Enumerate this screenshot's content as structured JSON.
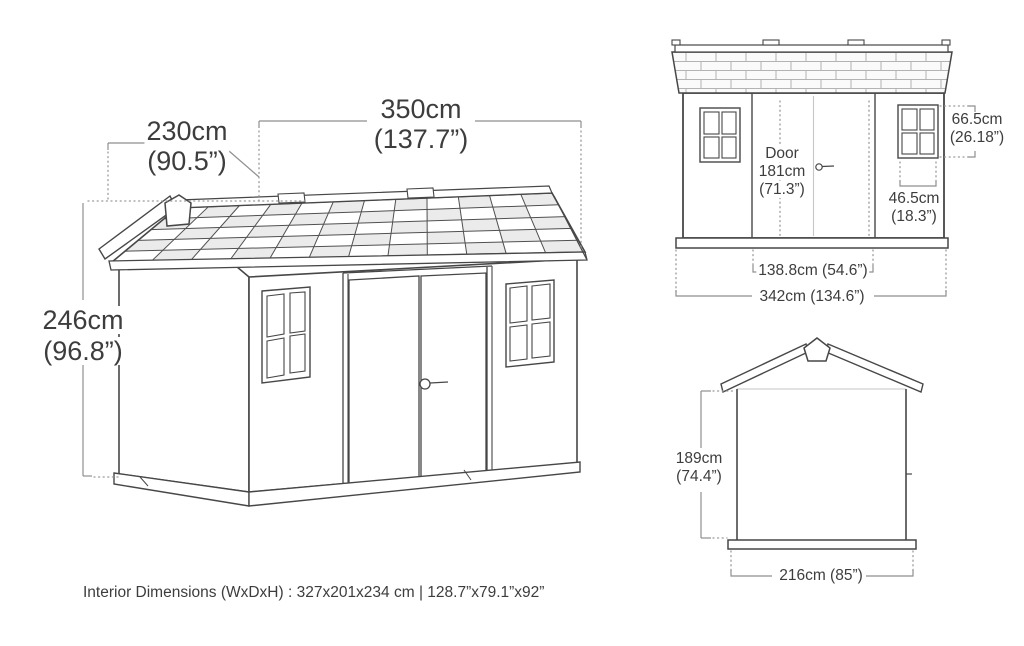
{
  "colors": {
    "background": "#ffffff",
    "line": "#474747",
    "dim_line": "#8f8f8f",
    "text": "#3d3d3d",
    "shingle_shade": "#ebebeb",
    "shingle_grid": "#505050"
  },
  "perspective_view": {
    "depth_label": {
      "cm": "230cm",
      "inches": "(90.5”)"
    },
    "width_label": {
      "cm": "350cm",
      "inches": "(137.7”)"
    },
    "height_label": {
      "cm": "246cm",
      "inches": "(96.8”)"
    }
  },
  "front_view": {
    "door_label": {
      "line1": "Door",
      "line2": "181cm",
      "line3": "(71.3”)"
    },
    "window_height_label": {
      "cm": "66.5cm",
      "inches": "(26.18”)"
    },
    "window_width_label": {
      "cm": "46.5cm",
      "inches": "(18.3”)"
    },
    "door_span_label": "138.8cm (54.6”)",
    "overall_width_label": "342cm (134.6”)"
  },
  "side_view": {
    "wall_height_label": {
      "cm": "189cm",
      "inches": "(74.4”)"
    },
    "overall_width_label": "216cm (85”)"
  },
  "footer": {
    "interior_dimensions": "Interior Dimensions (WxDxH) : 327x201x234 cm | 128.7”x79.1”x92”"
  }
}
